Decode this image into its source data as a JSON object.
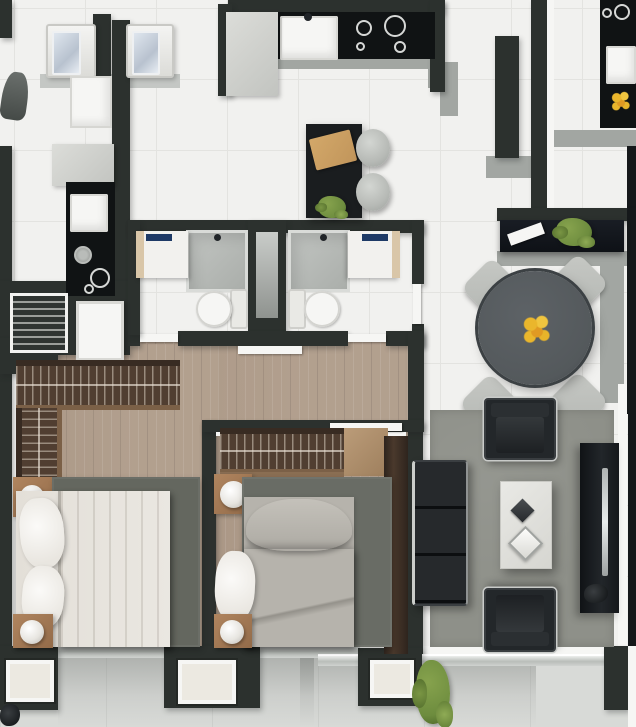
{
  "scene": {
    "description": "Top-down 3D rendered apartment floor plan: kitchen with island and stools, two bathrooms with shaft, two bedrooms with wardrobes and beds, dining table with four chairs, living room with sofa, armchairs, coffee table and TV console, balcony along bottom, neighboring units at edges",
    "width": 636,
    "height": 727
  },
  "palette": {
    "wall": "#2c312e",
    "wallDark": "#15181a",
    "tile": "#f1f1ef",
    "tileLine": "#e3e3e0",
    "balcony": "#d8dad7",
    "wood": "#b3a190",
    "wardrobe": "#503e31",
    "wardrobeDark": "#382b22",
    "rugBedroom1": "#64675f",
    "rugBedroom2": "#696c65",
    "rugLiving": "#8e9089",
    "counter": "#101314",
    "island": "#1a1d1f",
    "grayWall": "#a2a6a2",
    "grayLight": "#c4c7c4",
    "white": "#f6f6f4",
    "cream": "#ece9e1",
    "bedWhite": "#eae7e1",
    "bedGray": "#b6b3ac",
    "sofaBlack": "#23272a",
    "chairGray": "#c6c8c4",
    "tableGray": "#54595c",
    "nightstandWood": "#b0855f",
    "plantGreen": "#6d8c3e",
    "flowerYellow": "#eab62c",
    "faucetNavy": "#1e3a66",
    "boardTan": "#d3a869",
    "thresholdGray": "#b9bdb9"
  },
  "elements": [
    {
      "n": "base-floor",
      "c": "tilefloor",
      "x": 0,
      "y": 0,
      "w": 636,
      "h": 727
    },
    {
      "n": "balcony-floor",
      "c": "bfloor",
      "x": 0,
      "y": 658,
      "w": 636,
      "h": 69
    },
    {
      "n": "balcony-shadow-left",
      "c": "bshadow",
      "x": 58,
      "y": 658,
      "w": 256,
      "h": 69
    },
    {
      "n": "balcony-shadow-right",
      "c": "bshadow",
      "x": 300,
      "y": 658,
      "w": 236,
      "h": 69
    },
    {
      "n": "hallway-floor",
      "c": "wood",
      "x": 128,
      "y": 338,
      "w": 296,
      "h": 86
    },
    {
      "n": "bedroom1-floor",
      "c": "wood",
      "x": 12,
      "y": 344,
      "w": 206,
      "h": 310
    },
    {
      "n": "bedroom2-floor",
      "c": "wood",
      "x": 216,
      "y": 424,
      "w": 194,
      "h": 230
    },
    {
      "n": "bedroom1-left-trim",
      "c": "whitebox",
      "x": 11,
      "y": 350,
      "w": 5,
      "h": 298
    },
    {
      "n": "bottom-white-band",
      "c": "whitebox",
      "x": 10,
      "y": 646,
      "w": 626,
      "h": 12
    },
    {
      "n": "dining-parapet-vertical",
      "c": "gray",
      "x": 600,
      "y": 263,
      "w": 24,
      "h": 140
    },
    {
      "n": "dining-parapet-horizontal",
      "c": "gray",
      "x": 497,
      "y": 251,
      "w": 139,
      "h": 15
    },
    {
      "n": "unitR-floor-band",
      "c": "gray",
      "x": 549,
      "y": 130,
      "w": 87,
      "h": 17
    },
    {
      "n": "kitchen-counter-edge",
      "c": "gray",
      "x": 243,
      "y": 57,
      "w": 192,
      "h": 12
    },
    {
      "n": "kitchen-corner-cap-1",
      "c": "gray",
      "x": 428,
      "y": 62,
      "w": 30,
      "h": 26
    },
    {
      "n": "kitchen-corner-cap-2",
      "c": "gray",
      "x": 440,
      "y": 86,
      "w": 18,
      "h": 30
    },
    {
      "n": "entry-wall-cap",
      "c": "gray",
      "x": 486,
      "y": 156,
      "w": 48,
      "h": 22
    },
    {
      "n": "laundry-counter-shadow",
      "c": "graylight",
      "x": 40,
      "y": 74,
      "w": 140,
      "h": 14
    },
    {
      "n": "wall-top-left",
      "c": "wall",
      "x": 0,
      "y": 0,
      "w": 12,
      "h": 38
    },
    {
      "n": "wall-laundry-pillar",
      "c": "wall",
      "x": 93,
      "y": 14,
      "w": 18,
      "h": 64
    },
    {
      "n": "wall-unitL-divider",
      "c": "wall",
      "x": 112,
      "y": 20,
      "w": 18,
      "h": 296
    },
    {
      "n": "wall-kitchen-top",
      "c": "wall",
      "x": 228,
      "y": 0,
      "w": 216,
      "h": 13
    },
    {
      "n": "wall-kitchen-left",
      "c": "wall",
      "x": 218,
      "y": 4,
      "w": 14,
      "h": 92
    },
    {
      "n": "wall-kitchen-right",
      "c": "wall",
      "x": 430,
      "y": 0,
      "w": 15,
      "h": 92
    },
    {
      "n": "wall-entry-stub",
      "c": "wall",
      "x": 495,
      "y": 36,
      "w": 24,
      "h": 122
    },
    {
      "n": "wall-unitR-divider",
      "c": "wall",
      "x": 531,
      "y": 0,
      "w": 16,
      "h": 222
    },
    {
      "n": "unitR-divider-trim",
      "c": "whitebox",
      "x": 547,
      "y": 0,
      "w": 7,
      "h": 214
    },
    {
      "n": "wall-right-edge-top",
      "c": "walldark",
      "x": 627,
      "y": 146,
      "w": 9,
      "h": 78
    },
    {
      "n": "wall-outer-left",
      "c": "wall",
      "x": 0,
      "y": 146,
      "w": 12,
      "h": 514
    },
    {
      "n": "wall-unitL-block",
      "c": "wall",
      "x": 0,
      "y": 281,
      "w": 130,
      "h": 74
    },
    {
      "n": "wall-bath-top",
      "c": "wall",
      "x": 128,
      "y": 220,
      "w": 296,
      "h": 13
    },
    {
      "n": "wall-shaft",
      "c": "wall",
      "x": 248,
      "y": 220,
      "w": 38,
      "h": 126
    },
    {
      "n": "shaft-duct",
      "c": "shaftcol",
      "x": 256,
      "y": 232,
      "w": 22,
      "h": 86
    },
    {
      "n": "wall-bath-bottom-left",
      "c": "wall",
      "x": 128,
      "y": 331,
      "w": 12,
      "h": 15
    },
    {
      "n": "wall-bath-bottom-mid",
      "c": "wall",
      "x": 178,
      "y": 331,
      "w": 170,
      "h": 15
    },
    {
      "n": "wall-bath-bottom-right",
      "c": "wall",
      "x": 386,
      "y": 331,
      "w": 38,
      "h": 15
    },
    {
      "n": "bathA-door",
      "c": "doorslab",
      "x": 140,
      "y": 334,
      "w": 38,
      "h": 8
    },
    {
      "n": "bathB-door",
      "c": "doorslab",
      "x": 348,
      "y": 334,
      "w": 38,
      "h": 8
    },
    {
      "n": "wall-bath-left",
      "c": "wall",
      "x": 128,
      "y": 220,
      "w": 12,
      "h": 115
    },
    {
      "n": "wall-bath-right-upper",
      "c": "wall",
      "x": 412,
      "y": 220,
      "w": 12,
      "h": 64
    },
    {
      "n": "wall-bath-right-lower",
      "c": "wall",
      "x": 412,
      "y": 324,
      "w": 12,
      "h": 22
    },
    {
      "n": "bathB-side-door",
      "c": "doorslab",
      "x": 413,
      "y": 284,
      "w": 8,
      "h": 40
    },
    {
      "n": "wall-corridor",
      "c": "wall",
      "x": 408,
      "y": 331,
      "w": 16,
      "h": 95
    },
    {
      "n": "wall-bedroom-divider",
      "c": "wall",
      "x": 202,
      "y": 420,
      "w": 14,
      "h": 238
    },
    {
      "n": "wall-bedroom2-right",
      "c": "wall",
      "x": 408,
      "y": 424,
      "w": 15,
      "h": 234
    },
    {
      "n": "wall-bedroom2-top",
      "c": "wall",
      "x": 202,
      "y": 420,
      "w": 222,
      "h": 12
    },
    {
      "n": "bedroom2-top-trim",
      "c": "whitebox",
      "x": 216,
      "y": 432,
      "w": 190,
      "h": 4
    },
    {
      "n": "bedroom2-door",
      "c": "doorslab",
      "x": 330,
      "y": 423,
      "w": 72,
      "h": 8
    },
    {
      "n": "bedroom1-door",
      "c": "doorslab",
      "x": 238,
      "y": 346,
      "w": 64,
      "h": 8
    },
    {
      "n": "wall-bedroom1-corner",
      "c": "wall",
      "x": 0,
      "y": 338,
      "w": 58,
      "h": 36
    },
    {
      "n": "wall-dining-top",
      "c": "wall",
      "x": 497,
      "y": 208,
      "w": 139,
      "h": 13
    },
    {
      "n": "wall-right-edge-mid",
      "c": "walldark",
      "x": 627,
      "y": 208,
      "w": 9,
      "h": 206
    },
    {
      "n": "living-right-trim",
      "c": "whitebox",
      "x": 618,
      "y": 384,
      "w": 9,
      "h": 266
    },
    {
      "n": "wall-right-edge-living",
      "c": "walldark",
      "x": 628,
      "y": 384,
      "w": 8,
      "h": 278
    },
    {
      "n": "threshold-bedroom1",
      "c": "threshold",
      "x": 56,
      "y": 642,
      "w": 110,
      "h": 16
    },
    {
      "n": "threshold-bedroom2",
      "c": "threshold",
      "x": 258,
      "y": 642,
      "w": 102,
      "h": 16
    },
    {
      "n": "threshold-living",
      "c": "threshold",
      "x": 318,
      "y": 654,
      "w": 290,
      "h": 12
    },
    {
      "n": "wall-bottom-1",
      "c": "wall",
      "x": 0,
      "y": 646,
      "w": 58,
      "h": 64
    },
    {
      "n": "wall-bottom-2",
      "c": "wall",
      "x": 164,
      "y": 646,
      "w": 96,
      "h": 62
    },
    {
      "n": "wall-bottom-3",
      "c": "wall",
      "x": 358,
      "y": 648,
      "w": 64,
      "h": 58
    },
    {
      "n": "wall-bottom-4",
      "c": "wall",
      "x": 604,
      "y": 646,
      "w": 24,
      "h": 64
    },
    {
      "n": "bottom-right-trim",
      "c": "whitebox",
      "x": 628,
      "y": 646,
      "w": 8,
      "h": 81
    },
    {
      "n": "window-1",
      "c": "winframe",
      "x": 6,
      "y": 660,
      "w": 48,
      "h": 42
    },
    {
      "n": "window-2",
      "c": "winframe",
      "x": 178,
      "y": 660,
      "w": 58,
      "h": 44
    },
    {
      "n": "window-3",
      "c": "winframe",
      "x": 370,
      "y": 660,
      "w": 44,
      "h": 38
    },
    {
      "n": "bathA-shower",
      "c": "shower",
      "x": 186,
      "y": 230,
      "w": 62,
      "h": 62
    },
    {
      "n": "bathB-shower",
      "c": "shower",
      "x": 288,
      "y": 230,
      "w": 62,
      "h": 62
    },
    {
      "n": "bathA-vanity",
      "c": "vanity",
      "x": 136,
      "y": 231,
      "w": 52,
      "h": 47
    },
    {
      "n": "bathB-vanity",
      "c": "vanityR",
      "x": 348,
      "y": 231,
      "w": 52,
      "h": 47
    },
    {
      "n": "bathA-faucets",
      "c": "faucets",
      "x": 146,
      "y": 234,
      "w": 26,
      "h": 7
    },
    {
      "n": "bathB-faucets",
      "c": "faucets",
      "x": 362,
      "y": 234,
      "w": 26,
      "h": 7
    },
    {
      "n": "bathA-showerhead",
      "c": "dot",
      "x": 214,
      "y": 234,
      "w": 7,
      "h": 7
    },
    {
      "n": "bathB-showerhead",
      "c": "dot",
      "x": 320,
      "y": 234,
      "w": 7,
      "h": 7
    },
    {
      "n": "bathA-toilet",
      "c": "toilet",
      "x": 196,
      "y": 289,
      "w": 52,
      "h": 40
    },
    {
      "n": "bathB-toilet",
      "c": "toiletR",
      "x": 288,
      "y": 289,
      "w": 52,
      "h": 40
    },
    {
      "n": "washer-1",
      "c": "washer",
      "x": 46,
      "y": 24,
      "w": 50,
      "h": 54
    },
    {
      "n": "washer-2",
      "c": "washer",
      "x": 126,
      "y": 24,
      "w": 48,
      "h": 54
    },
    {
      "n": "laundry-sink",
      "c": "lsink",
      "x": 70,
      "y": 76,
      "w": 42,
      "h": 52
    },
    {
      "n": "ironing-board",
      "c": "iron",
      "x": 2,
      "y": 72,
      "w": 26,
      "h": 48,
      "r": 8
    },
    {
      "n": "unitL-fridge",
      "c": "fridge",
      "x": 52,
      "y": 144,
      "w": 62,
      "h": 42
    },
    {
      "n": "unitL-counter",
      "c": "black",
      "x": 66,
      "y": 182,
      "w": 49,
      "h": 114
    },
    {
      "n": "unitL-sink",
      "c": "sinkbox",
      "x": 70,
      "y": 194,
      "w": 38,
      "h": 38
    },
    {
      "n": "unitL-knob",
      "c": "ringB",
      "x": 74,
      "y": 246,
      "w": 18,
      "h": 18
    },
    {
      "n": "unitL-burner-1",
      "c": "ring",
      "x": 90,
      "y": 268,
      "w": 20,
      "h": 20
    },
    {
      "n": "unitL-burner-2",
      "c": "ringS",
      "x": 84,
      "y": 284,
      "w": 10,
      "h": 10
    },
    {
      "n": "unitL-shelf",
      "c": "shelfstripe",
      "x": 10,
      "y": 293,
      "w": 58,
      "h": 60
    },
    {
      "n": "unitL-appliance",
      "c": "whiteboxB",
      "x": 76,
      "y": 301,
      "w": 48,
      "h": 60
    },
    {
      "n": "kitchen-counter",
      "c": "black",
      "x": 243,
      "y": 12,
      "w": 192,
      "h": 47
    },
    {
      "n": "kitchen-sink",
      "c": "sinkbox",
      "x": 280,
      "y": 16,
      "w": 58,
      "h": 44
    },
    {
      "n": "kitchen-faucet",
      "c": "dot",
      "x": 304,
      "y": 13,
      "w": 8,
      "h": 8
    },
    {
      "n": "cooktop-burner-1",
      "c": "ring",
      "x": 356,
      "y": 20,
      "w": 16,
      "h": 16
    },
    {
      "n": "cooktop-burner-2",
      "c": "ring",
      "x": 384,
      "y": 15,
      "w": 22,
      "h": 22
    },
    {
      "n": "cooktop-burner-3",
      "c": "ringS",
      "x": 356,
      "y": 42,
      "w": 9,
      "h": 9
    },
    {
      "n": "cooktop-burner-4",
      "c": "ringS",
      "x": 394,
      "y": 41,
      "w": 12,
      "h": 12
    },
    {
      "n": "kitchen-fridge",
      "c": "fridge",
      "x": 226,
      "y": 12,
      "w": 52,
      "h": 84
    },
    {
      "n": "kitchen-island",
      "c": "black2",
      "x": 306,
      "y": 124,
      "w": 56,
      "h": 94
    },
    {
      "n": "cutting-board",
      "c": "board",
      "x": 312,
      "y": 134,
      "w": 42,
      "h": 32,
      "r": -14
    },
    {
      "n": "island-plant",
      "c": "plant",
      "x": 318,
      "y": 196,
      "w": 28,
      "h": 22
    },
    {
      "n": "stool-1",
      "c": "stool",
      "x": 356,
      "y": 129,
      "w": 34,
      "h": 38
    },
    {
      "n": "stool-2",
      "c": "stool",
      "x": 356,
      "y": 173,
      "w": 34,
      "h": 38
    },
    {
      "n": "unitR-counter",
      "c": "black",
      "x": 600,
      "y": 0,
      "w": 36,
      "h": 128
    },
    {
      "n": "unitR-burner-1",
      "c": "ring",
      "x": 614,
      "y": 4,
      "w": 16,
      "h": 16
    },
    {
      "n": "unitR-burner-2",
      "c": "ringS",
      "x": 602,
      "y": 8,
      "w": 10,
      "h": 10
    },
    {
      "n": "unitR-sink",
      "c": "sinkbox",
      "x": 606,
      "y": 46,
      "w": 30,
      "h": 38
    },
    {
      "n": "unitR-flowers",
      "c": "flowers",
      "x": 610,
      "y": 90,
      "w": 22,
      "h": 22
    },
    {
      "n": "sideboard",
      "c": "sideboard",
      "x": 500,
      "y": 220,
      "w": 124,
      "h": 32
    },
    {
      "n": "sideboard-decor",
      "c": "decorW",
      "x": 508,
      "y": 228,
      "w": 36,
      "h": 12,
      "r": -20
    },
    {
      "n": "sideboard-plant",
      "c": "plant",
      "x": 556,
      "y": 218,
      "w": 36,
      "h": 28
    },
    {
      "n": "dining-chair-nw",
      "c": "chair",
      "x": 470,
      "y": 266,
      "w": 44,
      "h": 44,
      "r": 45
    },
    {
      "n": "dining-chair-ne",
      "c": "chair",
      "x": 556,
      "y": 262,
      "w": 44,
      "h": 44,
      "r": 45
    },
    {
      "n": "dining-chair-sw",
      "c": "chair",
      "x": 468,
      "y": 382,
      "w": 44,
      "h": 44,
      "r": 45
    },
    {
      "n": "dining-chair-se",
      "c": "chair",
      "x": 556,
      "y": 380,
      "w": 44,
      "h": 44,
      "r": 45
    },
    {
      "n": "dining-table",
      "c": "dtable",
      "x": 478,
      "y": 271,
      "w": 114,
      "h": 114
    },
    {
      "n": "table-flowers",
      "c": "flowers",
      "x": 521,
      "y": 313,
      "w": 32,
      "h": 32
    },
    {
      "n": "bed1-wardrobe-top",
      "c": "wardrobeH",
      "x": 16,
      "y": 360,
      "w": 164,
      "h": 50
    },
    {
      "n": "bed1-wardrobe-side",
      "c": "wardrobeV",
      "x": 16,
      "y": 408,
      "w": 46,
      "h": 76
    },
    {
      "n": "bed1-nightstand-a",
      "c": "nightstand",
      "x": 13,
      "y": 477,
      "w": 40,
      "h": 40
    },
    {
      "n": "bed1-lamp-a",
      "c": "lamp",
      "x": 20,
      "y": 485,
      "w": 24,
      "h": 24
    },
    {
      "n": "bed1-rug",
      "c": "rug1",
      "x": 52,
      "y": 477,
      "w": 148,
      "h": 170
    },
    {
      "n": "bed1-bed",
      "c": "bedW",
      "x": 16,
      "y": 491,
      "w": 154,
      "h": 156
    },
    {
      "n": "bed1-blanket",
      "c": "blanketW",
      "x": 58,
      "y": 491,
      "w": 112,
      "h": 156
    },
    {
      "n": "bed1-pillow-a",
      "c": "pillowW",
      "x": 20,
      "y": 498,
      "w": 44,
      "h": 70,
      "r": -4
    },
    {
      "n": "bed1-pillow-b",
      "c": "pillowW",
      "x": 22,
      "y": 566,
      "w": 42,
      "h": 62,
      "r": 5
    },
    {
      "n": "bed1-nightstand-b",
      "c": "nightstand",
      "x": 13,
      "y": 614,
      "w": 40,
      "h": 34
    },
    {
      "n": "bed1-lamp-b",
      "c": "lamp",
      "x": 20,
      "y": 620,
      "w": 24,
      "h": 24
    },
    {
      "n": "bed2-wardrobe-top",
      "c": "wardrobeH",
      "x": 220,
      "y": 428,
      "w": 124,
      "h": 46
    },
    {
      "n": "bed2-wardrobe-shelf",
      "c": "shelfwood",
      "x": 220,
      "y": 472,
      "w": 124,
      "h": 12
    },
    {
      "n": "bed2-dresser",
      "c": "dresser",
      "x": 344,
      "y": 428,
      "w": 44,
      "h": 48
    },
    {
      "n": "bed2-wardrobe-side",
      "c": "wardrobeSolid",
      "x": 384,
      "y": 436,
      "w": 24,
      "h": 218
    },
    {
      "n": "bed2-nightstand-a",
      "c": "nightstand",
      "x": 214,
      "y": 474,
      "w": 38,
      "h": 40
    },
    {
      "n": "bed2-lamp-a",
      "c": "lamp",
      "x": 220,
      "y": 481,
      "w": 27,
      "h": 27
    },
    {
      "n": "bed2-rug",
      "c": "rug2",
      "x": 242,
      "y": 477,
      "w": 150,
      "h": 170
    },
    {
      "n": "bed2-bed",
      "c": "bedG",
      "x": 244,
      "y": 497,
      "w": 110,
      "h": 150
    },
    {
      "n": "bed2-pillow",
      "c": "pillowG",
      "x": 246,
      "y": 499,
      "w": 106,
      "h": 52
    },
    {
      "n": "bed2-blanket",
      "c": "blanketG",
      "x": 244,
      "y": 549,
      "w": 110,
      "h": 98
    },
    {
      "n": "bed2-pillows-white",
      "c": "pillowW",
      "x": 215,
      "y": 551,
      "w": 40,
      "h": 70,
      "r": 3
    },
    {
      "n": "bed2-nightstand-b",
      "c": "nightstand",
      "x": 214,
      "y": 614,
      "w": 38,
      "h": 34
    },
    {
      "n": "bed2-lamp-b",
      "c": "lamp",
      "x": 220,
      "y": 620,
      "w": 24,
      "h": 24
    },
    {
      "n": "living-rug",
      "c": "rug3",
      "x": 430,
      "y": 410,
      "w": 184,
      "h": 237
    },
    {
      "n": "sofa",
      "c": "sofa",
      "x": 412,
      "y": 460,
      "w": 56,
      "h": 146
    },
    {
      "n": "armchair-top",
      "c": "armchair",
      "x": 484,
      "y": 398,
      "w": 72,
      "h": 62
    },
    {
      "n": "armchair-bottom",
      "c": "armchair2",
      "x": 484,
      "y": 588,
      "w": 72,
      "h": 64
    },
    {
      "n": "coffee-table",
      "c": "ctable",
      "x": 500,
      "y": 481,
      "w": 52,
      "h": 88
    },
    {
      "n": "decor-diamond-dark",
      "c": "diamondD",
      "x": 514,
      "y": 502,
      "w": 17,
      "h": 17,
      "r": 45
    },
    {
      "n": "decor-diamond-light",
      "c": "diamondL",
      "x": 513,
      "y": 531,
      "w": 25,
      "h": 25,
      "r": 45
    },
    {
      "n": "tv-console",
      "c": "tvconsole",
      "x": 580,
      "y": 443,
      "w": 39,
      "h": 170
    },
    {
      "n": "tv",
      "c": "tvline",
      "x": 602,
      "y": 468,
      "w": 6,
      "h": 108
    },
    {
      "n": "tv-decor",
      "c": "decorDark",
      "x": 584,
      "y": 584,
      "w": 24,
      "h": 19
    },
    {
      "n": "balcony-plant",
      "c": "plant",
      "x": 416,
      "y": 660,
      "w": 34,
      "h": 64
    },
    {
      "n": "balcony-corner-decor",
      "c": "decorDark",
      "x": 0,
      "y": 704,
      "w": 20,
      "h": 22
    }
  ]
}
